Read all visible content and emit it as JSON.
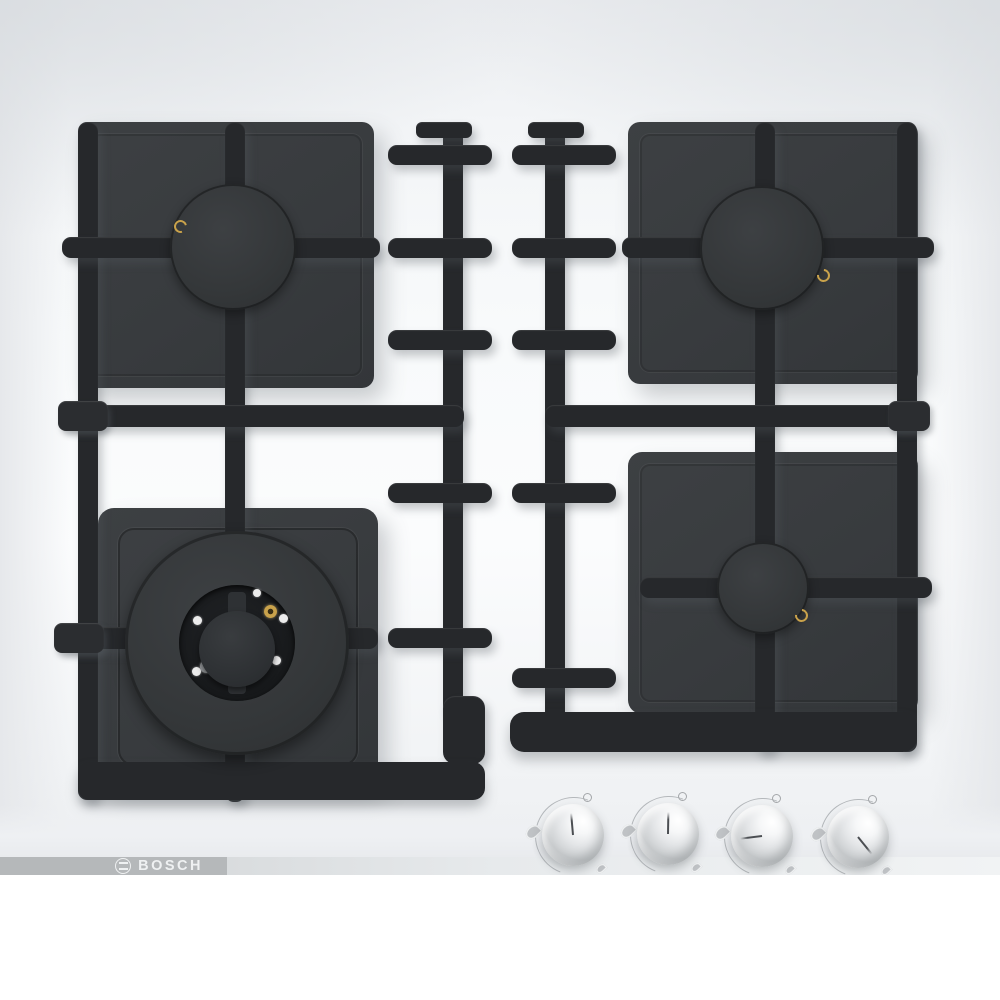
{
  "image": {
    "description": "Top view product photo of a white built-in four-burner gas hob with black cast-iron pan supports and four metallic control knobs",
    "brand": "BOSCH"
  },
  "logo": {
    "text": "BOSCH",
    "icon": "bosch-armature-icon"
  },
  "colors": {
    "pan_support": "#26282b",
    "burner_plate": "#383b3e",
    "burner_cap": "#35383b",
    "glass_surface": "#f8fafb",
    "knob_metal": "#d9dbdd",
    "ignition_brass": "#c9a24b",
    "logo_band": "#b5b8ba"
  },
  "burners": [
    {
      "id": "top-left",
      "size": "standard"
    },
    {
      "id": "top-right",
      "size": "standard"
    },
    {
      "id": "bottom-left",
      "size": "wok-triple-ring"
    },
    {
      "id": "bottom-right",
      "size": "economy"
    }
  ],
  "knobs": [
    {
      "id": "knob-1",
      "angle_deg": -5
    },
    {
      "id": "knob-2",
      "angle_deg": 1
    },
    {
      "id": "knob-3",
      "angle_deg": -97
    },
    {
      "id": "knob-4",
      "angle_deg": 141
    }
  ]
}
